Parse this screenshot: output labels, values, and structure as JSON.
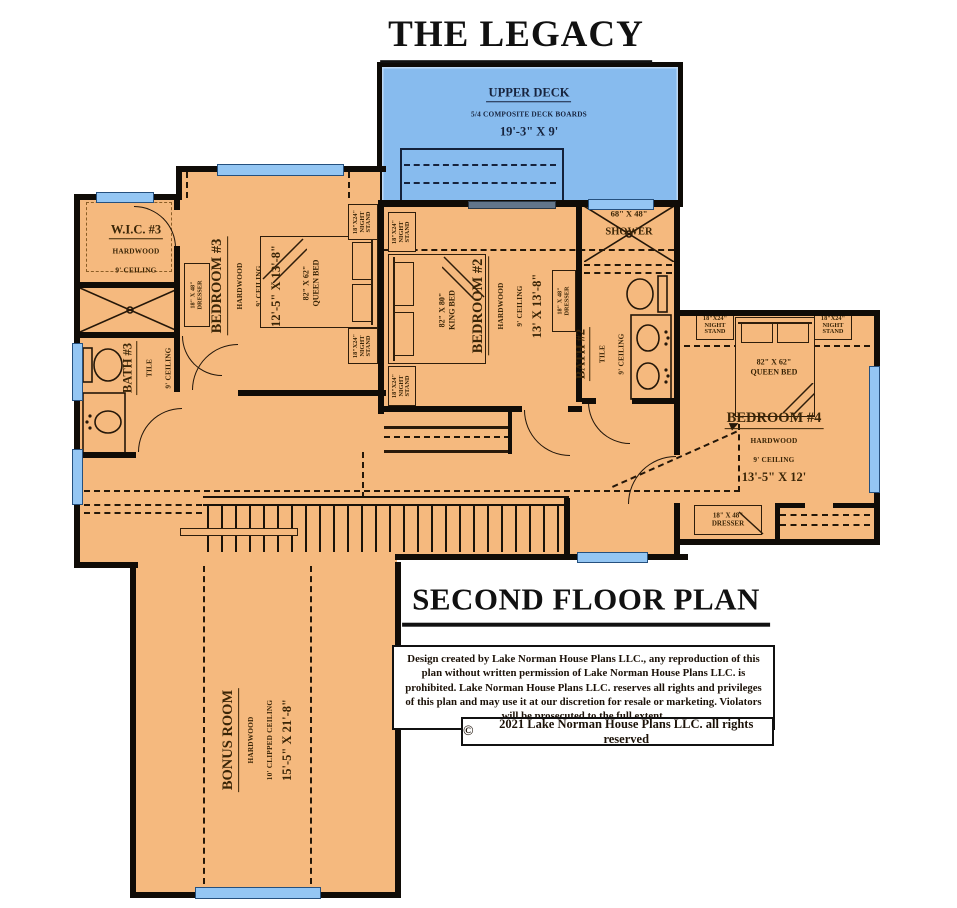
{
  "title": "THE LEGACY",
  "floor_title": "SECOND FLOOR PLAN",
  "deck": {
    "name": "UPPER DECK",
    "material": "5/4 COMPOSITE DECK BOARDS",
    "size": "19'-3\" X 9'"
  },
  "rooms": {
    "wic3": {
      "name": "W.I.C. #3",
      "floor": "HARDWOOD",
      "ceiling": "9' CEILING"
    },
    "bedroom3": {
      "name": "BEDROOM #3",
      "floor": "HARDWOOD",
      "ceiling": "9' CEILING",
      "size": "12'-5\" X 13'-8\""
    },
    "bedroom2": {
      "name": "BEDROOM #2",
      "floor": "HARDWOOD",
      "ceiling": "9' CEILING",
      "size": "13' X 13'-8\""
    },
    "bedroom4": {
      "name": "BEDROOM #4",
      "floor": "HARDWOOD",
      "ceiling": "9' CEILING",
      "size": "13'-5\" X 12'"
    },
    "bath3": {
      "name": "BATH #3",
      "floor": "TILE",
      "ceiling": "9' CEILING"
    },
    "bath2": {
      "name": "BATH #2",
      "floor": "TILE",
      "ceiling": "9' CEILING"
    },
    "bonus": {
      "name": "BONUS ROOM",
      "floor": "HARDWOOD",
      "ceiling": "10' CLIPPED CEILING",
      "size": "15'-5\" X 21'-8\""
    },
    "shower": {
      "size": "68\" X 48\"",
      "name": "SHOWER"
    }
  },
  "furniture": {
    "night_stand": {
      "size": "18\"X24\"",
      "line1": "NIGHT",
      "line2": "STAND"
    },
    "dresser": {
      "size": "18\" X 48\"",
      "name": "DRESSER"
    },
    "queen_bed": {
      "size": "82\" X 62\"",
      "name": "QUEEN BED"
    },
    "king_bed": {
      "size": "82\" X 80\"",
      "name": "KING BED"
    }
  },
  "legal": {
    "disclaimer": "Design created by Lake Norman House Plans LLC., any reproduction of this plan without written permission of Lake Norman House Plans LLC. is prohibited.  Lake Norman House Plans LLC. reserves all rights and privileges of this plan and may use it at our discretion for resale or marketing.  Violators will be prosecuted to the full extent.",
    "copyright_symbol": "©",
    "copyright_text": "2021 Lake Norman House Plans LLC. all rights reserved"
  },
  "colors": {
    "floor": "#F5B97E",
    "deck": "#87BBEE",
    "window": "#94C6F3",
    "wall": "#100C07",
    "ink": "#3A2507"
  }
}
